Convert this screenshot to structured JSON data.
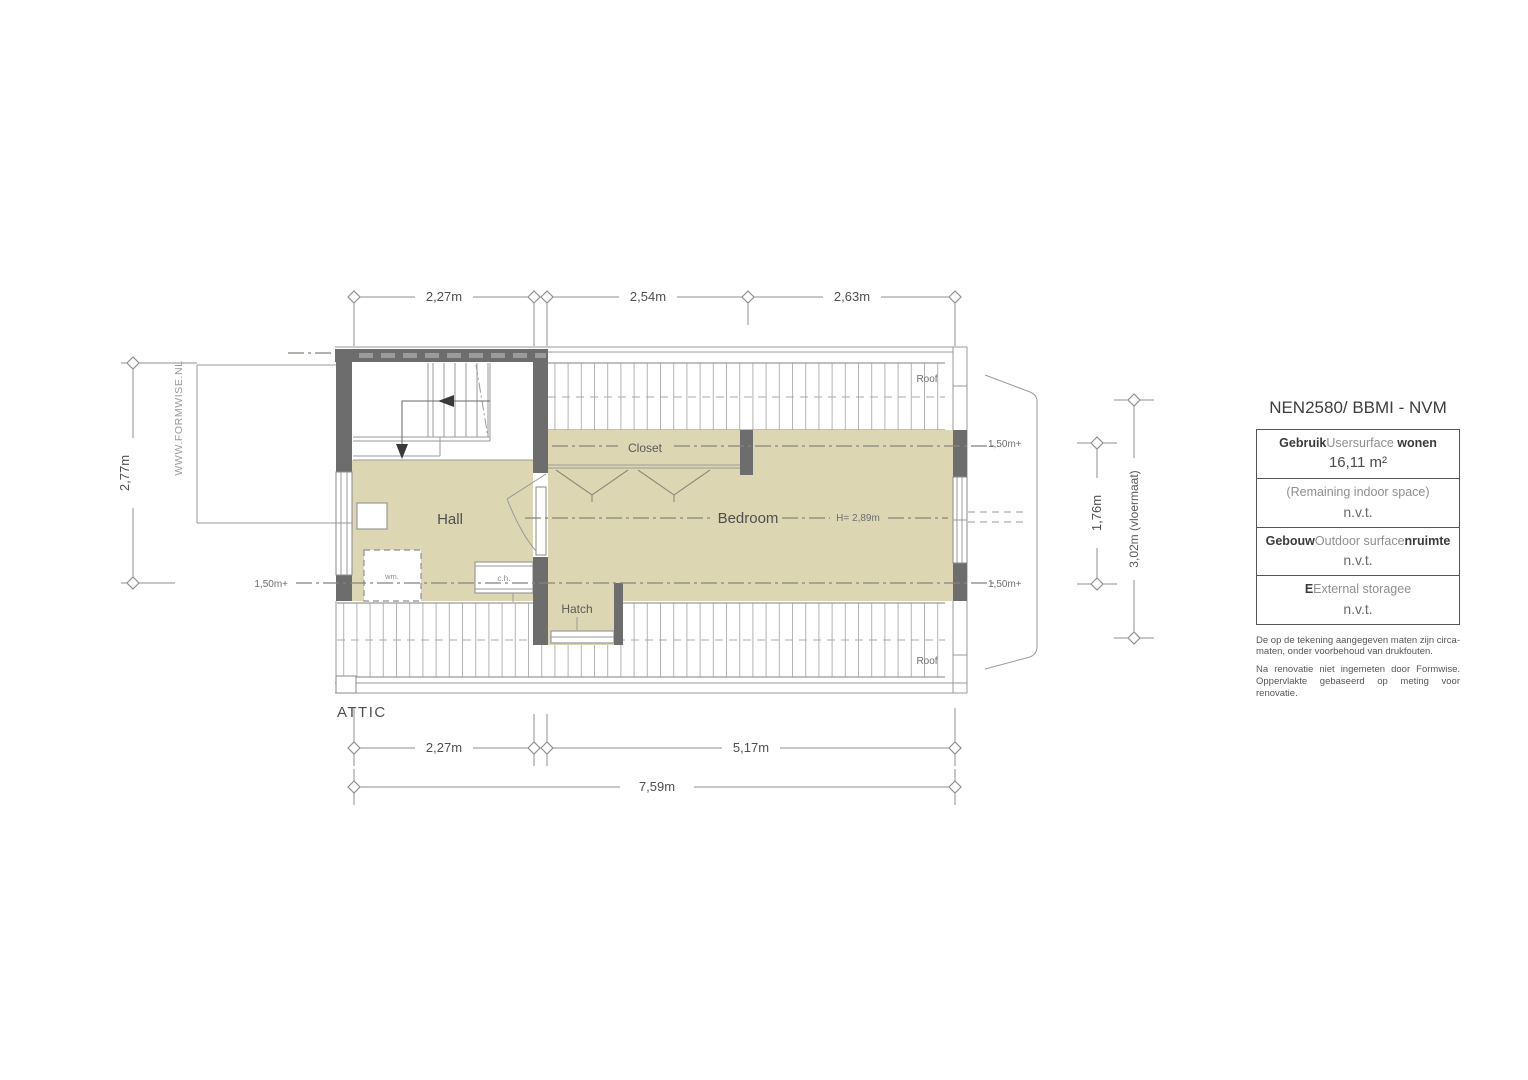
{
  "plan": {
    "floor_name": "ATTIC",
    "watermark": "WWW.FORMWISE.NL",
    "rooms": {
      "hall": "Hall",
      "bedroom": "Bedroom",
      "closet": "Closet"
    },
    "features": {
      "hatch": "Hatch",
      "wm": "wm.",
      "ch": "c.h."
    },
    "roof_top": "Roof",
    "roof_bottom": "Roof",
    "height_note": "H= 2,89m",
    "headroom_left": "1,50m+",
    "headroom_right_top": "1,50m+",
    "headroom_right_bottom": "1,50m+"
  },
  "dims": {
    "top": [
      "2,27m",
      "2,54m",
      "2,63m"
    ],
    "bottom": [
      "2,27m",
      "5,17m"
    ],
    "total": "7,59m",
    "left": "2,77m",
    "right_inner": "1,76m",
    "right_floor": "3,02m (vloermaat)"
  },
  "colors": {
    "floor": "#dcd6b2",
    "wall": "#6d6d6d"
  },
  "legend": {
    "title": "NEN2580/ BBMI - NVM",
    "rows": [
      {
        "parts": [
          {
            "t": "Gebruik"
          },
          {
            "t": "Usersurface"
          },
          {
            "t": " wonen"
          }
        ],
        "value": "16,11 m²"
      },
      {
        "parts": [
          {
            "t": "(Remaining indoor space)"
          }
        ],
        "value": "n.v.t."
      },
      {
        "parts": [
          {
            "t": "Gebouw"
          },
          {
            "t": "Outdoor surface"
          },
          {
            "t": "nruimte"
          }
        ],
        "value": "n.v.t."
      },
      {
        "parts": [
          {
            "t": "E"
          },
          {
            "t": "External storage"
          },
          {
            "t": "e"
          }
        ],
        "value": "n.v.t."
      }
    ],
    "notes": [
      "De op de tekening aangegeven maten zijn circa-maten, onder voorbehoud van drukfouten.",
      "Na renovatie niet ingemeten door Formwise. Oppervlakte gebaseerd op meting voor renovatie."
    ]
  }
}
